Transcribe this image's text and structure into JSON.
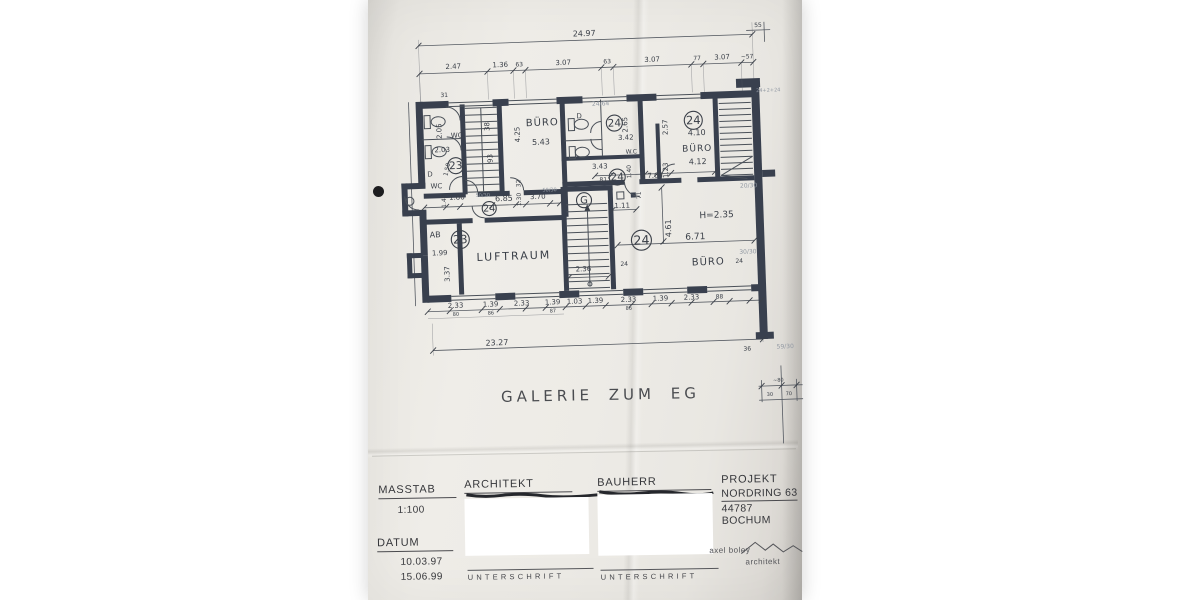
{
  "colors": {
    "ink": "#3b4049",
    "wall": "#39404e",
    "faint": "#9299a3",
    "paper": "#eceae5"
  },
  "drawing": {
    "title": "GALERIE ZUM EG",
    "plan_labels": [
      {
        "t": "24.97",
        "x": 590,
        "y": 36,
        "s": 8
      },
      {
        "t": "55",
        "x": 764,
        "y": 33,
        "s": 6
      },
      {
        "t": "2.47",
        "x": 458,
        "y": 64,
        "s": 7
      },
      {
        "t": "1.36",
        "x": 505,
        "y": 64,
        "s": 7
      },
      {
        "t": "63",
        "x": 524,
        "y": 64,
        "s": 6
      },
      {
        "t": "3.07",
        "x": 568,
        "y": 64,
        "s": 7
      },
      {
        "t": "63",
        "x": 612,
        "y": 64,
        "s": 6
      },
      {
        "t": "3.07",
        "x": 657,
        "y": 64,
        "s": 7
      },
      {
        "t": "77",
        "x": 702,
        "y": 64,
        "s": 6
      },
      {
        "t": "3.07",
        "x": 727,
        "y": 64,
        "s": 7
      },
      {
        "t": "~57",
        "x": 752,
        "y": 64,
        "s": 6
      },
      {
        "t": "31",
        "x": 448,
        "y": 92,
        "s": 6
      },
      {
        "t": "24/64",
        "x": 604,
        "y": 106,
        "s": 6,
        "f": 1
      },
      {
        "t": "24+2+24",
        "x": 772,
        "y": 98,
        "s": 5,
        "f": 1
      },
      {
        "t": "2.05",
        "x": 444,
        "y": 126,
        "s": 7,
        "r": -90
      },
      {
        "t": "WC",
        "x": 459,
        "y": 133,
        "s": 7
      },
      {
        "t": "2.03",
        "x": 444,
        "y": 147,
        "s": 7
      },
      {
        "t": "38",
        "x": 492,
        "y": 123,
        "s": 7,
        "r": -90
      },
      {
        "t": "93",
        "x": 494,
        "y": 155,
        "s": 7,
        "r": -90
      },
      {
        "t": "BÜRO",
        "x": 545,
        "y": 124,
        "s": 10,
        "sp": 1
      },
      {
        "t": "4.25",
        "x": 522,
        "y": 132,
        "s": 7,
        "r": -90
      },
      {
        "t": "5.43",
        "x": 543,
        "y": 143,
        "s": 8
      },
      {
        "t": "32",
        "x": 521,
        "y": 181,
        "s": 6,
        "r": -90
      },
      {
        "t": "1.50",
        "x": 450,
        "y": 165,
        "s": 6,
        "r": -75
      },
      {
        "t": "D",
        "x": 431,
        "y": 171,
        "s": 7
      },
      {
        "t": "WC",
        "x": 437,
        "y": 183,
        "s": 7
      },
      {
        "t": "D",
        "x": 582,
        "y": 118,
        "s": 7
      },
      {
        "t": "2.65",
        "x": 630,
        "y": 126,
        "s": 7,
        "r": -90
      },
      {
        "t": "3.42",
        "x": 628,
        "y": 141,
        "s": 7
      },
      {
        "t": "W.C",
        "x": 633,
        "y": 155,
        "s": 6
      },
      {
        "t": "2.57",
        "x": 670,
        "y": 130,
        "s": 7,
        "r": -90
      },
      {
        "t": "4.10",
        "x": 699,
        "y": 139,
        "s": 8
      },
      {
        "t": "BÜRO",
        "x": 699,
        "y": 155,
        "s": 9,
        "sp": 1
      },
      {
        "t": "4.12",
        "x": 699,
        "y": 168,
        "s": 8
      },
      {
        "t": "1.23",
        "x": 669,
        "y": 173,
        "s": 7,
        "r": -90
      },
      {
        "t": "3.43",
        "x": 601,
        "y": 169,
        "s": 7
      },
      {
        "t": "81",
        "x": 604,
        "y": 182,
        "s": 6
      },
      {
        "t": "1.40",
        "x": 632,
        "y": 173,
        "s": 6,
        "r": -90
      },
      {
        "t": "7.64",
        "x": 656,
        "y": 180,
        "s": 7
      },
      {
        "t": "71",
        "x": 641,
        "y": 197,
        "s": 6,
        "r": -90
      },
      {
        "t": "1.40",
        "x": 446,
        "y": 196,
        "s": 6,
        "r": -90
      },
      {
        "t": "1.86",
        "x": 457,
        "y": 195,
        "s": 7
      },
      {
        "t": "50/30",
        "x": 483,
        "y": 193,
        "s": 5,
        "f": 1
      },
      {
        "t": "6.85",
        "x": 504,
        "y": 198,
        "s": 8
      },
      {
        "t": "1.30",
        "x": 521,
        "y": 197,
        "s": 6,
        "r": -90
      },
      {
        "t": "3.70",
        "x": 538,
        "y": 197,
        "s": 7
      },
      {
        "t": "50/30",
        "x": 550,
        "y": 190,
        "s": 5,
        "f": 1
      },
      {
        "t": "1.11",
        "x": 622,
        "y": 209,
        "s": 7
      },
      {
        "t": "H=2.35",
        "x": 716,
        "y": 222,
        "s": 9
      },
      {
        "t": "4.61",
        "x": 670,
        "y": 231,
        "s": 8,
        "r": -90
      },
      {
        "t": "6.71",
        "x": 694,
        "y": 243,
        "s": 9
      },
      {
        "t": "BÜRO",
        "x": 706,
        "y": 269,
        "s": 10,
        "sp": 1
      },
      {
        "t": "24",
        "x": 622,
        "y": 267,
        "s": 6
      },
      {
        "t": "24",
        "x": 737,
        "y": 268,
        "s": 6
      },
      {
        "t": "AB",
        "x": 434,
        "y": 232,
        "s": 8
      },
      {
        "t": "1.99",
        "x": 438,
        "y": 250,
        "s": 7
      },
      {
        "t": "3.37",
        "x": 447,
        "y": 269,
        "s": 7,
        "r": -90
      },
      {
        "t": "LUFTRAUM",
        "x": 512,
        "y": 257,
        "s": 11,
        "sp": 2
      },
      {
        "t": "2.36",
        "x": 581,
        "y": 271,
        "s": 7
      },
      {
        "t": "20/30",
        "x": 749,
        "y": 193,
        "s": 6,
        "f": 1
      },
      {
        "t": "30/30",
        "x": 746,
        "y": 259,
        "s": 6,
        "f": 1
      },
      {
        "t": "2.33",
        "x": 452,
        "y": 303,
        "s": 7
      },
      {
        "t": "80",
        "x": 452,
        "y": 311,
        "s": 5
      },
      {
        "t": "1.39",
        "x": 487,
        "y": 303,
        "s": 7
      },
      {
        "t": "86",
        "x": 487,
        "y": 311,
        "s": 5
      },
      {
        "t": "2.33",
        "x": 518,
        "y": 303,
        "s": 7
      },
      {
        "t": "1.39",
        "x": 549,
        "y": 303,
        "s": 7
      },
      {
        "t": "87",
        "x": 549,
        "y": 311,
        "s": 5
      },
      {
        "t": "1.03",
        "x": 571,
        "y": 303,
        "s": 7
      },
      {
        "t": "1.39",
        "x": 592,
        "y": 303,
        "s": 7
      },
      {
        "t": "2.33",
        "x": 625,
        "y": 303,
        "s": 7
      },
      {
        "t": "86",
        "x": 625,
        "y": 311,
        "s": 5
      },
      {
        "t": "1.39",
        "x": 657,
        "y": 303,
        "s": 7
      },
      {
        "t": "2.33",
        "x": 688,
        "y": 303,
        "s": 7
      },
      {
        "t": "88",
        "x": 716,
        "y": 303,
        "s": 6
      },
      {
        "t": "23.27",
        "x": 492,
        "y": 342,
        "s": 8
      },
      {
        "t": "36",
        "x": 742,
        "y": 356,
        "s": 6
      },
      {
        "t": "59/30",
        "x": 780,
        "y": 355,
        "s": 6,
        "f": 1
      },
      {
        "t": "~80",
        "x": 772,
        "y": 388,
        "s": 5
      },
      {
        "t": "30",
        "x": 763,
        "y": 402,
        "s": 5
      },
      {
        "t": "70",
        "x": 782,
        "y": 402,
        "s": 5
      }
    ],
    "plan_circles": [
      {
        "t": "23",
        "x": 457,
        "y": 161,
        "r": 8
      },
      {
        "t": "23",
        "x": 459,
        "y": 235,
        "r": 9
      },
      {
        "t": "24",
        "x": 617,
        "y": 124,
        "r": 8
      },
      {
        "t": "24",
        "x": 618,
        "y": 178,
        "r": 8
      },
      {
        "t": "24",
        "x": 696,
        "y": 124,
        "r": 9
      },
      {
        "t": "24",
        "x": 640,
        "y": 242,
        "r": 10
      },
      {
        "t": "24",
        "x": 489,
        "y": 205,
        "r": 7
      },
      {
        "t": "G",
        "x": 584,
        "y": 200,
        "r": 7.5
      }
    ]
  },
  "titleblock": {
    "masstab": {
      "label": "MASSTAB",
      "value": "1:100"
    },
    "datum": {
      "label": "DATUM",
      "date1": "10.03.97",
      "date2": "15.06.99"
    },
    "architekt": {
      "label": "ARCHITEKT",
      "unterschrift": "UNTERSCHRIFT"
    },
    "bauherr": {
      "label": "BAUHERR",
      "unterschrift": "UNTERSCHRIFT"
    },
    "projekt": {
      "label": "PROJEKT",
      "line1": "NORDRING 63",
      "line2": "44787 BOCHUM"
    },
    "logo": {
      "line1": "axel boley",
      "line2": "architekt"
    }
  }
}
